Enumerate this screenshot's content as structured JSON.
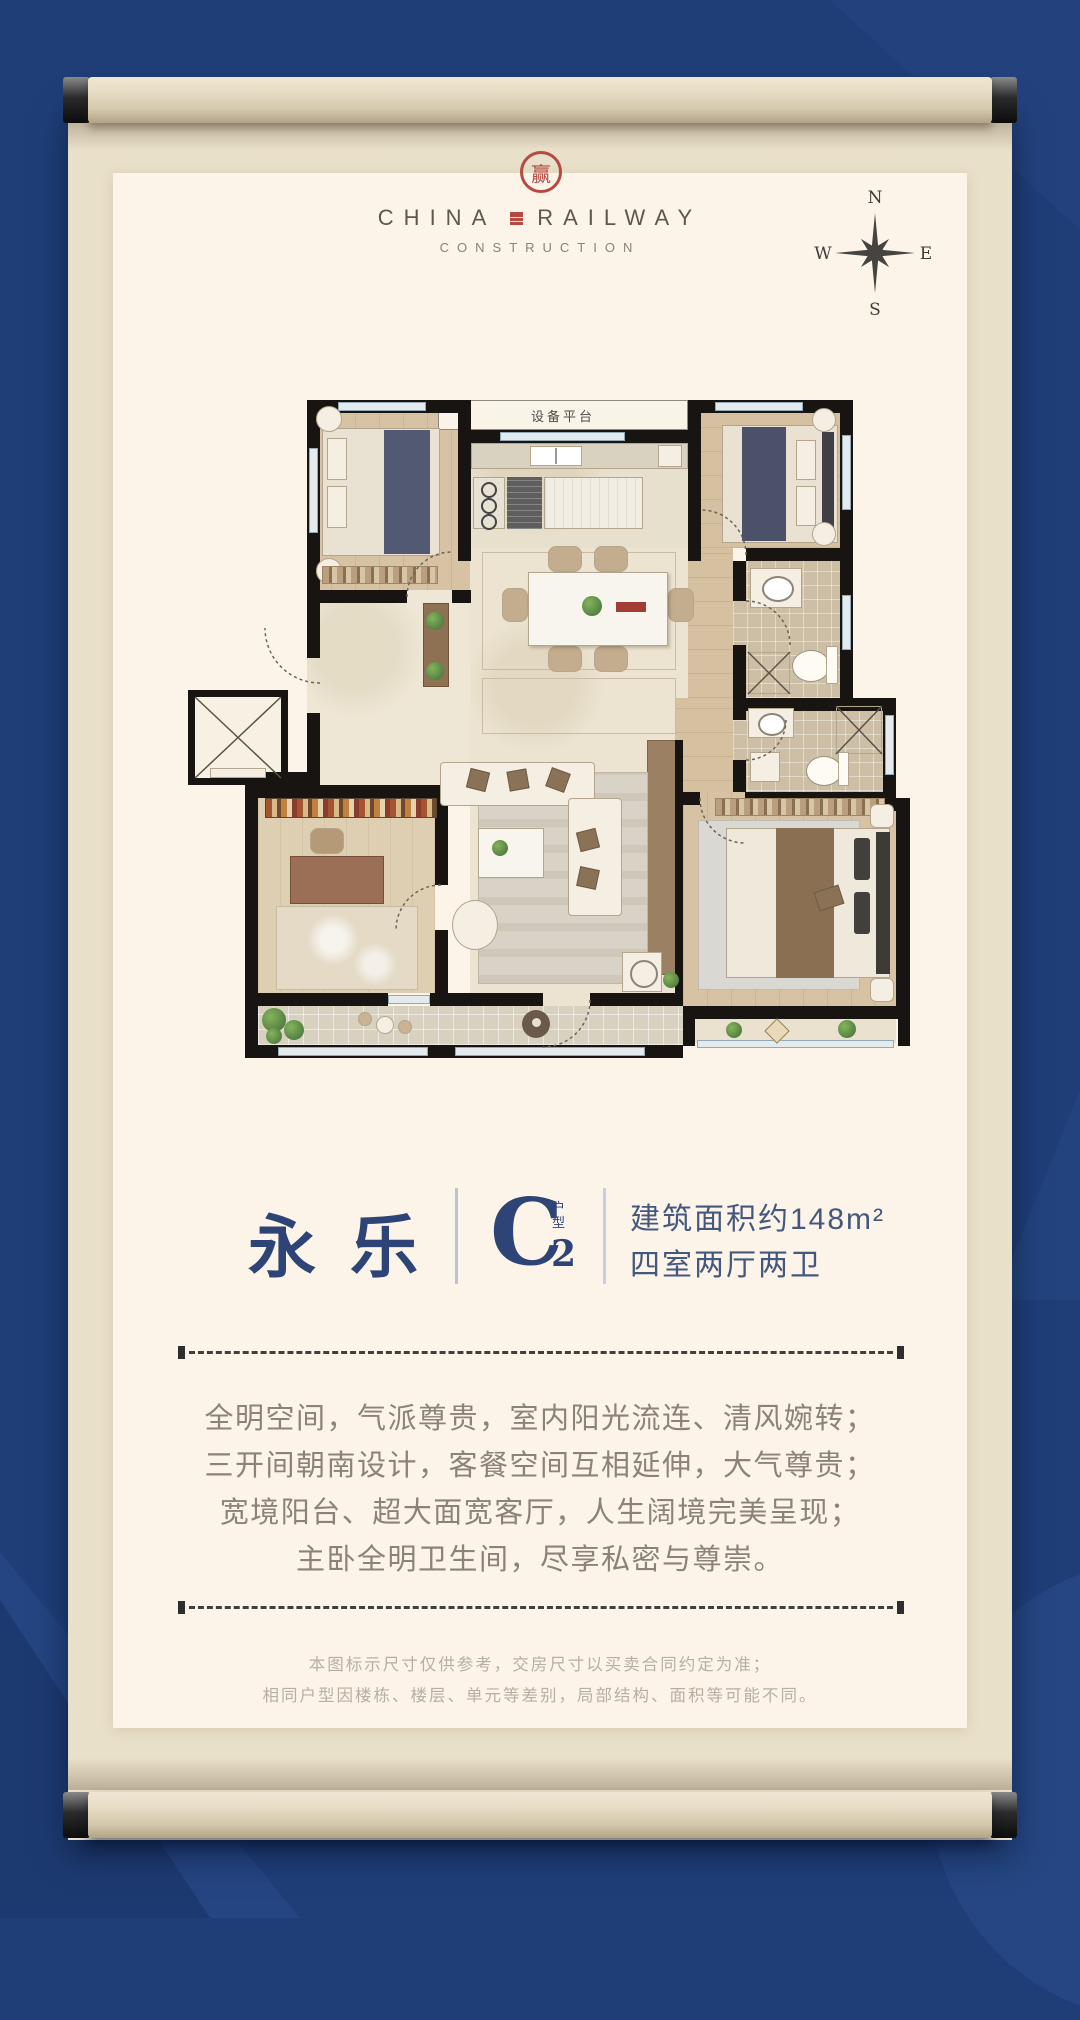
{
  "brand": {
    "seal_char": "赢",
    "name_left": "CHINA",
    "name_right": "RAILWAY",
    "subtitle": "CONSTRUCTION"
  },
  "compass": {
    "north": "N",
    "east": "E",
    "south": "S",
    "west": "W"
  },
  "floorplan": {
    "platform_label": "设备平台"
  },
  "unit": {
    "name": "永乐",
    "type_letter": "C",
    "type_number": "2",
    "type_tag": "户型",
    "area_line": "建筑面积约148m²",
    "layout_line": "四室两厅两卫"
  },
  "description": {
    "lines": [
      "全明空间，气派尊贵，室内阳光流连、清风婉转；",
      "三开间朝南设计，客餐空间互相延伸，大气尊贵；",
      "宽境阳台、超大面宽客厅，人生阔境完美呈现；",
      "主卧全明卫生间，尽享私密与尊崇。"
    ]
  },
  "disclaimer": {
    "lines": [
      "本图标示尺寸仅供参考，交房尺寸以买卖合同约定为准；",
      "相同户型因楼栋、楼层、单元等差别，局部结构、面积等可能不同。"
    ]
  },
  "colors": {
    "background_blue": "#1f3e78",
    "paper_beige": "#e9e0ca",
    "card_cream": "#fcf4e9",
    "navy_accent": "#2e4476",
    "seal_red": "#b44a42",
    "wall_black": "#181411"
  }
}
